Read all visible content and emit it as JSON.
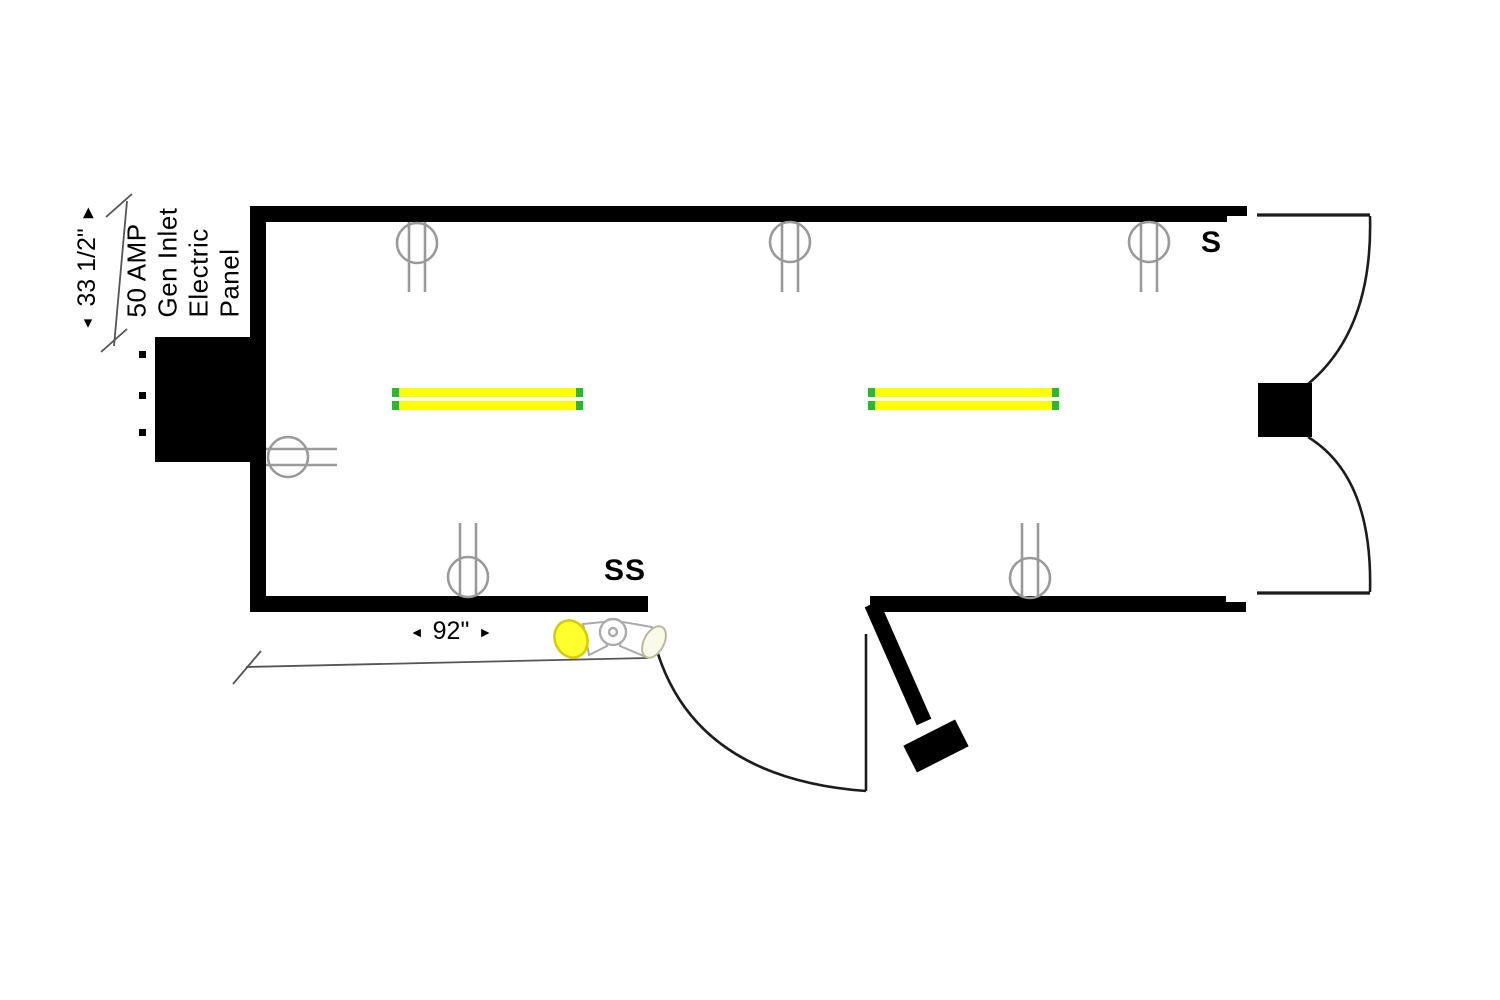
{
  "colors": {
    "wall": "#000000",
    "line_dark": "#1c1c1c",
    "sconce_gray": "#9a9a9a",
    "dim_gray": "#555555",
    "tube_yellow": "#ffff00",
    "tube_end_green": "#33b333",
    "lens_yellow": "#ffff2e",
    "lens_pale": "#fafae8"
  },
  "electric_panel": {
    "label_lines": [
      "50 AMP",
      "Gen Inlet",
      "Electric",
      "Panel"
    ]
  },
  "dimensions": {
    "panel_height": {
      "value": "33 1/2\"",
      "start_arrow": "◄",
      "end_arrow": "▶"
    },
    "door_distance": {
      "value": "92\"",
      "left_arrow": "◄",
      "right_arrow": "►"
    }
  },
  "switches": {
    "single": "S",
    "double": "SS"
  },
  "fixtures": {
    "wall_lights_top": 3,
    "wall_lights_bottom": 2,
    "wall_lights_left": 1,
    "fluorescent_fixtures": 2,
    "flood_lights": 1,
    "doors": 2
  }
}
